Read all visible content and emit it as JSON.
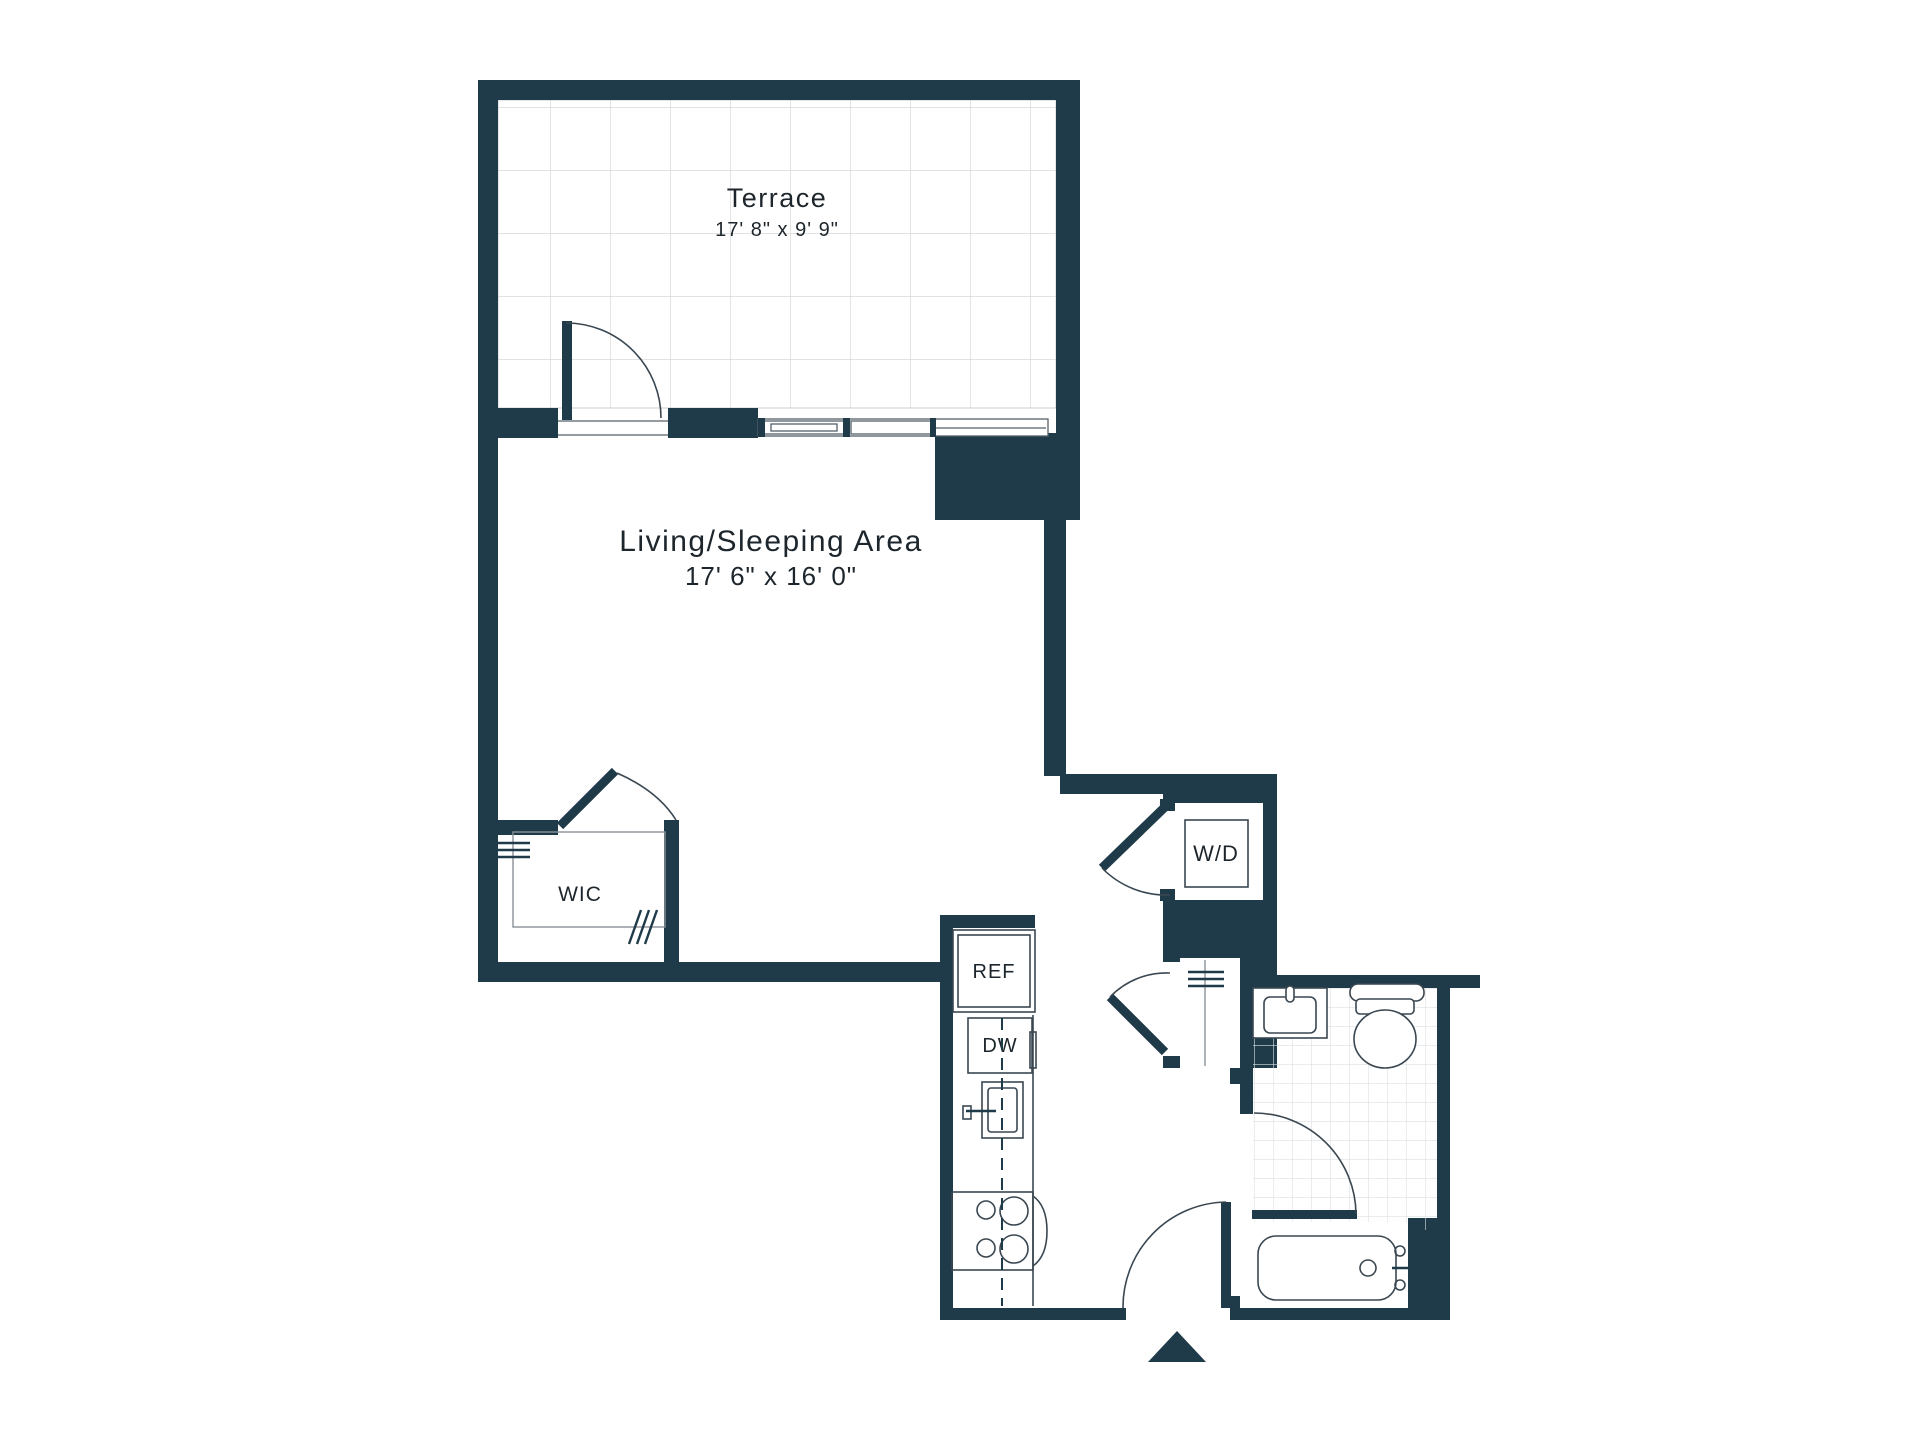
{
  "plan": {
    "title": "Studio apartment floor plan",
    "rooms": {
      "terrace": {
        "label": "Terrace",
        "dimensions": "17' 8\" x 9' 9\""
      },
      "living": {
        "label": "Living/Sleeping Area",
        "dimensions": "17' 6\" x 16' 0\""
      },
      "wic": {
        "label": "WIC"
      },
      "washer_dryer": {
        "label": "W/D"
      },
      "refrigerator": {
        "label": "REF"
      },
      "dishwasher": {
        "label": "DW"
      }
    },
    "colors": {
      "wall": "#1f3b49",
      "fixture_line": "#3a4751",
      "terrace_grid": "#d8d8d8",
      "tile_grid": "#dbe0e3",
      "text": "#1d262c",
      "background": "#ffffff"
    }
  }
}
